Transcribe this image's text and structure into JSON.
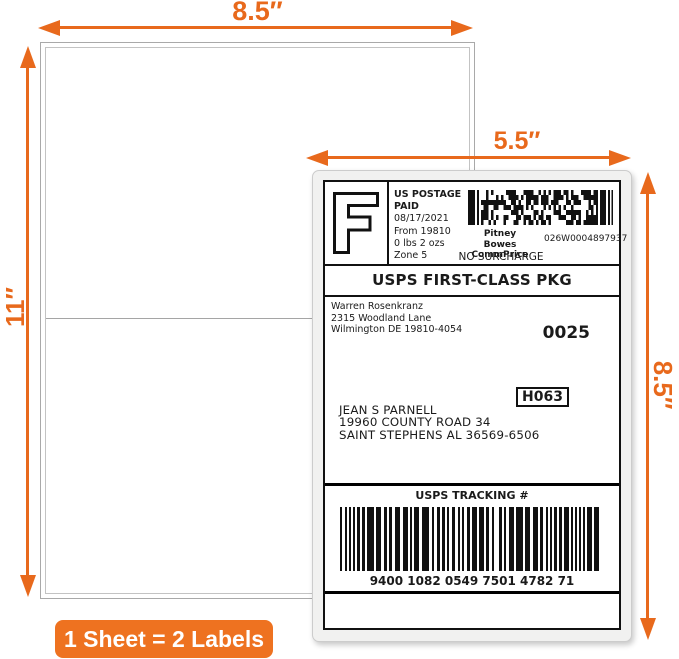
{
  "colors": {
    "accent": "#E8691C",
    "badge": "#EE7220"
  },
  "dimensions": {
    "sheet_width": "8.5″",
    "sheet_height": "11″",
    "label_width": "5.5″",
    "label_height": "8.5″"
  },
  "badge": {
    "text": "1 Sheet = 2 Labels"
  },
  "shipping_label": {
    "rate_letter": "F",
    "postage": {
      "header1": "US POSTAGE",
      "header2": "PAID",
      "details": [
        "08/17/2021",
        "From 19810",
        "0 lbs 2 ozs",
        "Zone 5"
      ]
    },
    "meter": {
      "carrier": "Pitney Bowes",
      "product": "CommPrice",
      "meter_number": "026W0004897937",
      "surcharge": "NO SURCHARGE"
    },
    "service": "USPS FIRST-CLASS PKG",
    "sender": {
      "name": "Warren Rosenkranz",
      "street": "2315 Woodland Lane",
      "city": "Wilmington DE 19810-4054"
    },
    "batch_number": "0025",
    "sort_code": "H063",
    "recipient": {
      "name": "JEAN S PARNELL",
      "street": "19960 COUNTY ROAD 34",
      "city": "SAINT STEPHENS AL 36569-6506"
    },
    "tracking": {
      "header": "USPS TRACKING #",
      "number": "9400 1082 0549 7501 4782 71"
    }
  }
}
